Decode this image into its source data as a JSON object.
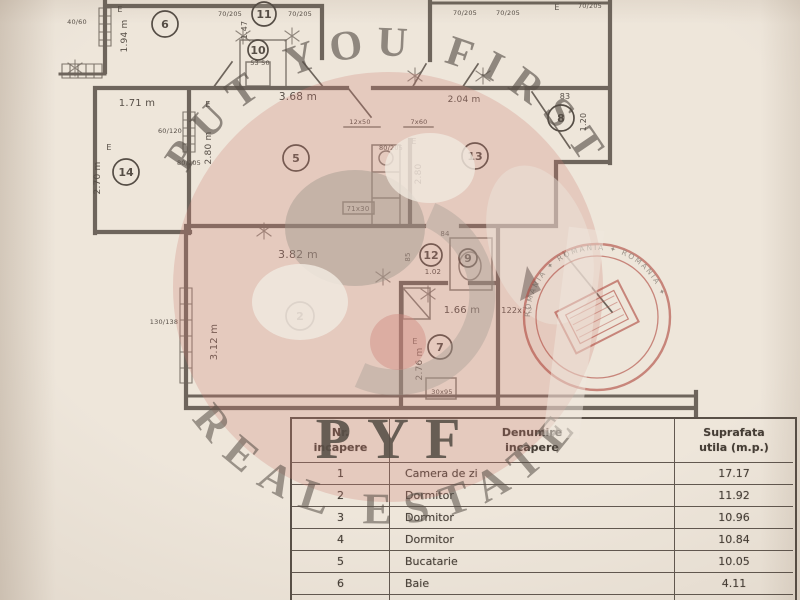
{
  "watermark": {
    "top": "PUT YOU FIRST",
    "bottom": "REAL ESTATE",
    "logo": "PYF",
    "pink": "#cf7d72",
    "text_red": "#b1736a",
    "text_gray": "#a59a8e"
  },
  "stamp": {
    "ring_text": "ROMANIA ✦ ROMANIA ✦ ROMANIA ✦",
    "color": "#b04a40"
  },
  "plan": {
    "ink": "#564e46",
    "rooms": [
      {
        "n": "6",
        "x": 165,
        "y": 24,
        "r": 13
      },
      {
        "n": "11",
        "x": 264,
        "y": 14,
        "r": 12
      },
      {
        "n": "10",
        "x": 258,
        "y": 50,
        "r": 10
      },
      {
        "n": "14",
        "x": 126,
        "y": 172,
        "r": 13
      },
      {
        "n": "5",
        "x": 296,
        "y": 158,
        "r": 13
      },
      {
        "n": "13",
        "x": 475,
        "y": 156,
        "r": 13
      },
      {
        "n": "8",
        "x": 561,
        "y": 118,
        "r": 13
      },
      {
        "n": "2",
        "x": 300,
        "y": 316,
        "r": 14
      },
      {
        "n": "12",
        "x": 431,
        "y": 255,
        "r": 11
      },
      {
        "n": "9",
        "x": 468,
        "y": 258,
        "r": 9
      },
      {
        "n": "7",
        "x": 440,
        "y": 347,
        "r": 12
      }
    ],
    "labels": [
      {
        "t": "1.94 m",
        "x": 127,
        "y": 36,
        "rot": -90,
        "s": 9
      },
      {
        "t": "1.71 m",
        "x": 137,
        "y": 106,
        "s": 10
      },
      {
        "t": "2.70 m",
        "x": 100,
        "y": 178,
        "rot": -90,
        "s": 9
      },
      {
        "t": "2.80 m",
        "x": 211,
        "y": 148,
        "rot": -90,
        "s": 9
      },
      {
        "t": "3.68 m",
        "x": 298,
        "y": 100,
        "s": 10.5
      },
      {
        "t": "2.04 m",
        "x": 464,
        "y": 102,
        "s": 9
      },
      {
        "t": "83",
        "x": 565,
        "y": 99,
        "s": 8
      },
      {
        "t": "1.20",
        "x": 586,
        "y": 122,
        "rot": -90,
        "s": 8
      },
      {
        "t": "1.47",
        "x": 247,
        "y": 30,
        "rot": -90,
        "s": 8
      },
      {
        "t": "2.80",
        "x": 421,
        "y": 174,
        "rot": -90,
        "s": 9
      },
      {
        "t": "3.82 m",
        "x": 298,
        "y": 258,
        "s": 11
      },
      {
        "t": "3.12 m",
        "x": 217,
        "y": 342,
        "rot": -90,
        "s": 10
      },
      {
        "t": "1.66 m",
        "x": 462,
        "y": 313,
        "s": 10
      },
      {
        "t": "122x72",
        "x": 517,
        "y": 313,
        "s": 8,
        "c": "#b84438",
        "n": "red-dimension-label"
      },
      {
        "t": "2.76 m",
        "x": 422,
        "y": 364,
        "rot": -90,
        "s": 9
      },
      {
        "t": "1.02",
        "x": 433,
        "y": 274,
        "s": 7
      },
      {
        "t": "85",
        "x": 410,
        "y": 257,
        "rot": -90,
        "s": 7
      },
      {
        "t": "84",
        "x": 445,
        "y": 236,
        "s": 7
      },
      {
        "t": "40/60",
        "x": 77,
        "y": 24,
        "s": 6.5
      },
      {
        "t": "70/205",
        "x": 230,
        "y": 16,
        "s": 6.5
      },
      {
        "t": "70/205",
        "x": 300,
        "y": 16,
        "s": 6.5
      },
      {
        "t": "53 50",
        "x": 260,
        "y": 65,
        "s": 6.5
      },
      {
        "t": "12x50",
        "x": 360,
        "y": 124,
        "s": 6.5
      },
      {
        "t": "7x60",
        "x": 419,
        "y": 124,
        "s": 6.5
      },
      {
        "t": "70/205",
        "x": 465,
        "y": 15,
        "s": 6.5
      },
      {
        "t": "70/205",
        "x": 508,
        "y": 15,
        "s": 6.5
      },
      {
        "t": "70/205",
        "x": 590,
        "y": 8,
        "s": 6.5
      },
      {
        "t": "80/205",
        "x": 391,
        "y": 150,
        "s": 6.5
      },
      {
        "t": "60/120",
        "x": 170,
        "y": 133,
        "s": 6.5
      },
      {
        "t": "80/205",
        "x": 189,
        "y": 165,
        "s": 6.5
      },
      {
        "t": "71x30",
        "x": 358,
        "y": 211,
        "s": 7
      },
      {
        "t": "130/138",
        "x": 164,
        "y": 324,
        "s": 6.5
      },
      {
        "t": "30x95",
        "x": 442,
        "y": 394,
        "s": 6.5
      },
      {
        "t": "E",
        "x": 120,
        "y": 12,
        "s": 8
      },
      {
        "t": "E",
        "x": 208,
        "y": 107,
        "s": 8
      },
      {
        "t": "E",
        "x": 109,
        "y": 150,
        "s": 8
      },
      {
        "t": "E",
        "x": 414,
        "y": 144,
        "s": 8
      },
      {
        "t": "E",
        "x": 415,
        "y": 344,
        "s": 8
      },
      {
        "t": "E",
        "x": 557,
        "y": 10,
        "s": 8
      }
    ]
  },
  "table": {
    "headers": [
      "Nr.\nincapere",
      "Denumire\nincapere",
      "Suprafata\nutila (m.p.)"
    ],
    "rows": [
      {
        "nr": "1",
        "name": "Camera de zi",
        "area": "17.17"
      },
      {
        "nr": "2",
        "name": "Dormitor",
        "area": "11.92"
      },
      {
        "nr": "3",
        "name": "Dormitor",
        "area": "10.96"
      },
      {
        "nr": "4",
        "name": "Dormitor",
        "area": "10.84"
      },
      {
        "nr": "5",
        "name": "Bucatarie",
        "area": "10.05"
      },
      {
        "nr": "6",
        "name": "Baie",
        "area": "4.11"
      },
      {
        "nr": "7",
        "name": "WC serviciu",
        "area": ""
      }
    ]
  }
}
